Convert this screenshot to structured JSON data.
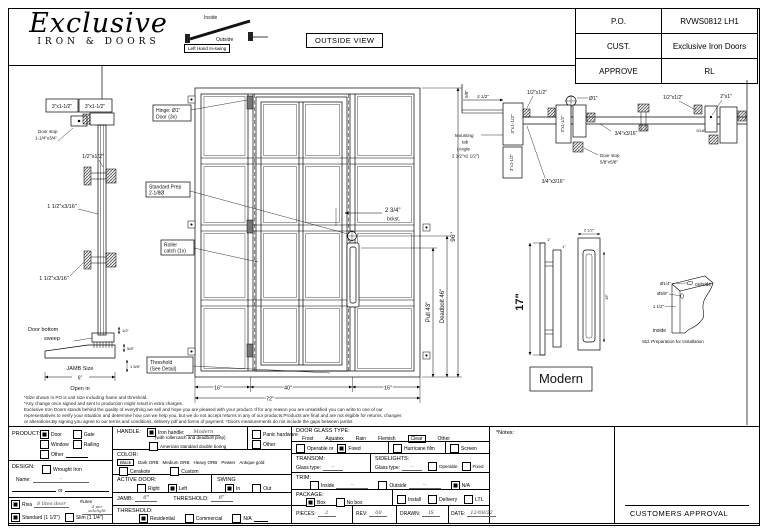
{
  "header": {
    "logo": {
      "script": "Exclusive",
      "sub": "IRON & DOORS"
    },
    "swing_diagram": {
      "inside": "Inside",
      "outside": "Outside",
      "caption": "Left Hand In-swing"
    },
    "view_label": "OUTSIDE VIEW",
    "info_rows": [
      {
        "label": "P.O.",
        "value": "RVWS0812 LH1"
      },
      {
        "label": "CUST.",
        "value": "Exclusive Iron Doors"
      },
      {
        "label": "APPROVE",
        "value": "RL"
      }
    ]
  },
  "drawing": {
    "jamb_section": {
      "frame_a": "3\"x1-1/2\"",
      "frame_b": "3\"x1-1/2\"",
      "door_stop_1": "Door stop",
      "door_stop_2": "1-1/4\"x3/4\"",
      "tab_dim": "1/2\"x1/2\"",
      "mid_dim": "1 1/2\"x3/16\"",
      "mid_dim2": "1 1/2\"x3/16\"",
      "sweep_1": "Door bottom",
      "sweep_2": "sweep",
      "sweep_dim": "1/2\"",
      "thr_dim_a": "5/8\"",
      "thr_dim_b": "1 5/8\"",
      "jamb_size": "JAMB Size",
      "jamb_width": "6\"",
      "open_in": "Open in"
    },
    "elevation": {
      "hinge_callout_1": "Hinge: Ø1\"",
      "hinge_callout_2": "Door (3x)",
      "prep_callout_1": "Standard Prep",
      "prep_callout_2": "2-1/8Ø",
      "roller_callout_1": "Roller",
      "roller_callout_2": "catch (1x)",
      "threshold_callout_1": "Threshold",
      "threshold_callout_2": "(See Detail)",
      "backset_1": "2 3/4\"",
      "backset_2": "bckst.",
      "dim_height": "96\"",
      "dim_pull": "Pull 43\"",
      "dim_deadbolt": "Deadbolt 46\"",
      "dim_left": "16\"",
      "dim_center": "40\"",
      "dim_right": "16\"",
      "dim_total": "72\""
    },
    "head_section": {
      "dim_58": "5/8\"",
      "dim_212": "2 1/2\"",
      "dim_half_a": "1/2\"x1/2\"",
      "dia_1": "Ø1\"",
      "mounting_1": "Mounting",
      "mounting_2": "tab",
      "mounting_3": "(Angle",
      "mounting_4": "2 1/2\"x2 1/2\")",
      "frame_a": "3\"x1-1/2\"",
      "frame_b": "3\"x1-1/2\"",
      "frame_c": "3\"x1-1/2\"",
      "tab_dim_a": "3/4\"x3/16\"",
      "tab_dim_b": "3/4\"x3/16\"",
      "door_stop_1": "Door stop",
      "door_stop_2": "5/8\"x5/8\"",
      "dim_half_b": "1/2\"x1/2\"",
      "dim_2x1": "2\"x1\"",
      "dim_516": "5/16\""
    },
    "handle": {
      "dim_17": "17\"",
      "dim_1a": "1\"",
      "dim_1b": "1\"",
      "dim_212": "2 1/2\"",
      "dim_16": "16\"",
      "name": "Modern"
    },
    "corner_detail": {
      "dia_quarter": "Ø1/4\"",
      "dia_58": "Ø5/8\"",
      "dim_112": "1 1/2\"",
      "outside": "outside",
      "inside": "inside",
      "caption": "Std. Preparation for Installation"
    }
  },
  "disclaimer": {
    "line1": "*Size shown in PO is unit size including frame and threshold.",
    "line2": "*Any change once signed and sent to production might result in extra charges.",
    "line3": "Exclusive Iron Doors stands behind the quality of everything we sell and hope you are pleased with your product. If for any reason you are unsatisfied you can write to one of our",
    "line4": "representatives to verify your situation and determine how can we help you, but we do not accept returns in any of our products.Products are final and are not eligible for returns, changes",
    "line5": "or alterations.By signing you agree to our terms and conditions, delivery pdf and forms of payment. *Doors measurements do not include the gaps between jambs"
  },
  "form": {
    "product": {
      "label": "PRODUCT:",
      "door": "Door",
      "gate": "Gate",
      "window": "Window",
      "railing": "Railing",
      "other": "Other"
    },
    "design": {
      "label": "DESIGN:",
      "wrought": "Wrought Iron",
      "name_label": "Name:",
      "name_value": "--",
      "or": "or"
    },
    "riva": {
      "label": "Riva",
      "value": "8 lites door",
      "lites_label": "#Lites",
      "lites_value": "4 per sidelight"
    },
    "thickness": {
      "standard": "Standard (1 1/2\")",
      "slim": "Slim (1 1/4\")"
    },
    "handle": {
      "label": "HANDLE:",
      "iron": "Iron handle:",
      "iron_value": "Modern",
      "iron_note": "(with rollercatch and deadbolt prep)",
      "american": "American standard double boring",
      "panic": "Panic hardware",
      "other": "Other"
    },
    "color": {
      "label": "COLOR:",
      "options": [
        "Black",
        "Dark ORB",
        "Medium ORB",
        "Heavy ORB",
        "Pewter",
        "Antique gold"
      ],
      "cerakote": "Cerakote",
      "custom": "Custom"
    },
    "active_door": {
      "label": "ACTIVE DOOR:",
      "right": "Right",
      "left": "Left"
    },
    "swing": {
      "label": "SWING",
      "in_opt": "In",
      "out_opt": "Out"
    },
    "jamb": {
      "label": "JAMB:",
      "value": "6\"",
      "threshold_label": "THRESHOLD:",
      "threshold_value": "6\""
    },
    "threshold": {
      "label": "THRESHOLD:",
      "residential": "Residential",
      "commercial": "Commercial",
      "na": "N/A"
    },
    "glass": {
      "label": "DOOR GLASS TYPE:",
      "options": [
        "Frost",
        "Aquatex",
        "Rain",
        "Flemish",
        "Clear",
        "Other"
      ],
      "operable": "Operable or",
      "fixed": "Fixed",
      "hurricane": "Hurricane film",
      "screen": "Screen"
    },
    "transom": {
      "label": "TRANSOM:",
      "glass_label": "Glass type:",
      "value": "--"
    },
    "sidelights": {
      "label": "SIDELIGHTS:",
      "glass_label": "Glass type:",
      "value": "--",
      "operable": "Operable",
      "fixed": "Fixed"
    },
    "trim": {
      "label": "TRIM:",
      "inside": "Inside",
      "inside_value": "--",
      "outside": "Outside",
      "outside_value": "--",
      "na": "N/A"
    },
    "package": {
      "label": "PACKAGE:",
      "box": "Box",
      "no_box": "No box",
      "install": "Install",
      "delivery": "Delivery",
      "ltl": "LTL"
    },
    "meta": {
      "pieces_label": "PIECES:",
      "pieces": "2",
      "rev_label": "REV:",
      "rev": "00",
      "drawn_label": "DRAWN:",
      "drawn": "IS",
      "date_label": "DATE:",
      "date": "12/08/22"
    },
    "notes_label": "*Notes:",
    "approval_label": "CUSTOMERS APPROVAL"
  }
}
